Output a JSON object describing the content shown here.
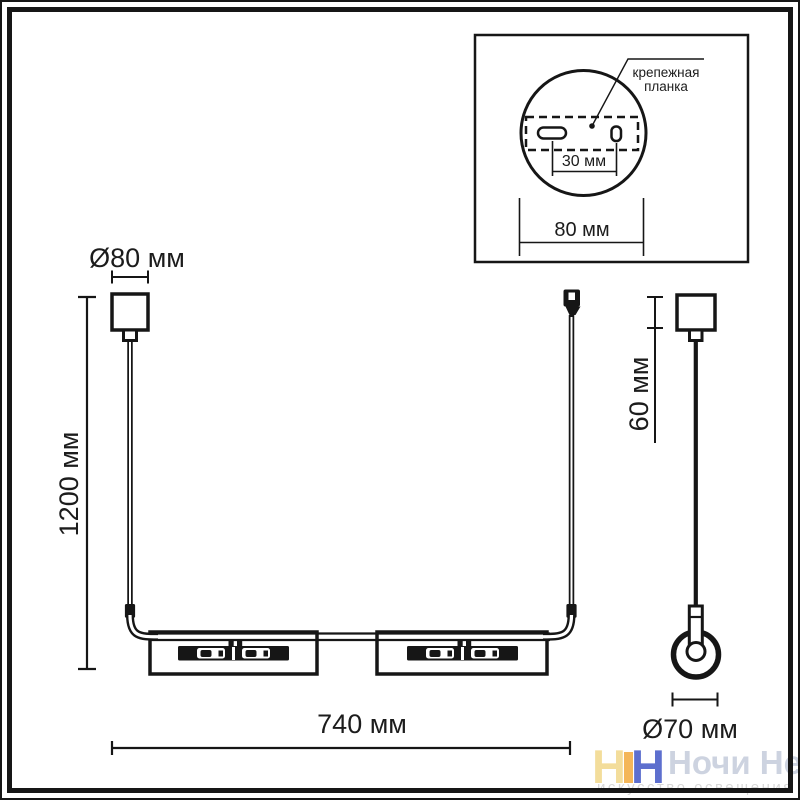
{
  "colors": {
    "line": "#161616",
    "logo_yellow": "#f3dd9b",
    "logo_orange": "#f2a93c",
    "logo_blue": "#4157c6",
    "brand_text": "#cdd3e0",
    "tagline_text": "#d8d8d8"
  },
  "inset": {
    "label": {
      "line1": "крепежная",
      "line2": "планка"
    },
    "dims": {
      "slot_spacing": "30 мм",
      "plate_width": "80 мм"
    }
  },
  "front_view": {
    "dims": {
      "canopy_diameter": "Ø80 мм",
      "suspension_height": "1200 мм",
      "fixture_width": "740 мм"
    }
  },
  "side_view": {
    "dims": {
      "canopy_height": "60 мм",
      "shade_diameter": "Ø70 мм"
    }
  },
  "watermark": {
    "logo_left": "Н",
    "logo_right": "Н",
    "brand": "Ночи Нет",
    "tagline": "искусство освещения"
  }
}
